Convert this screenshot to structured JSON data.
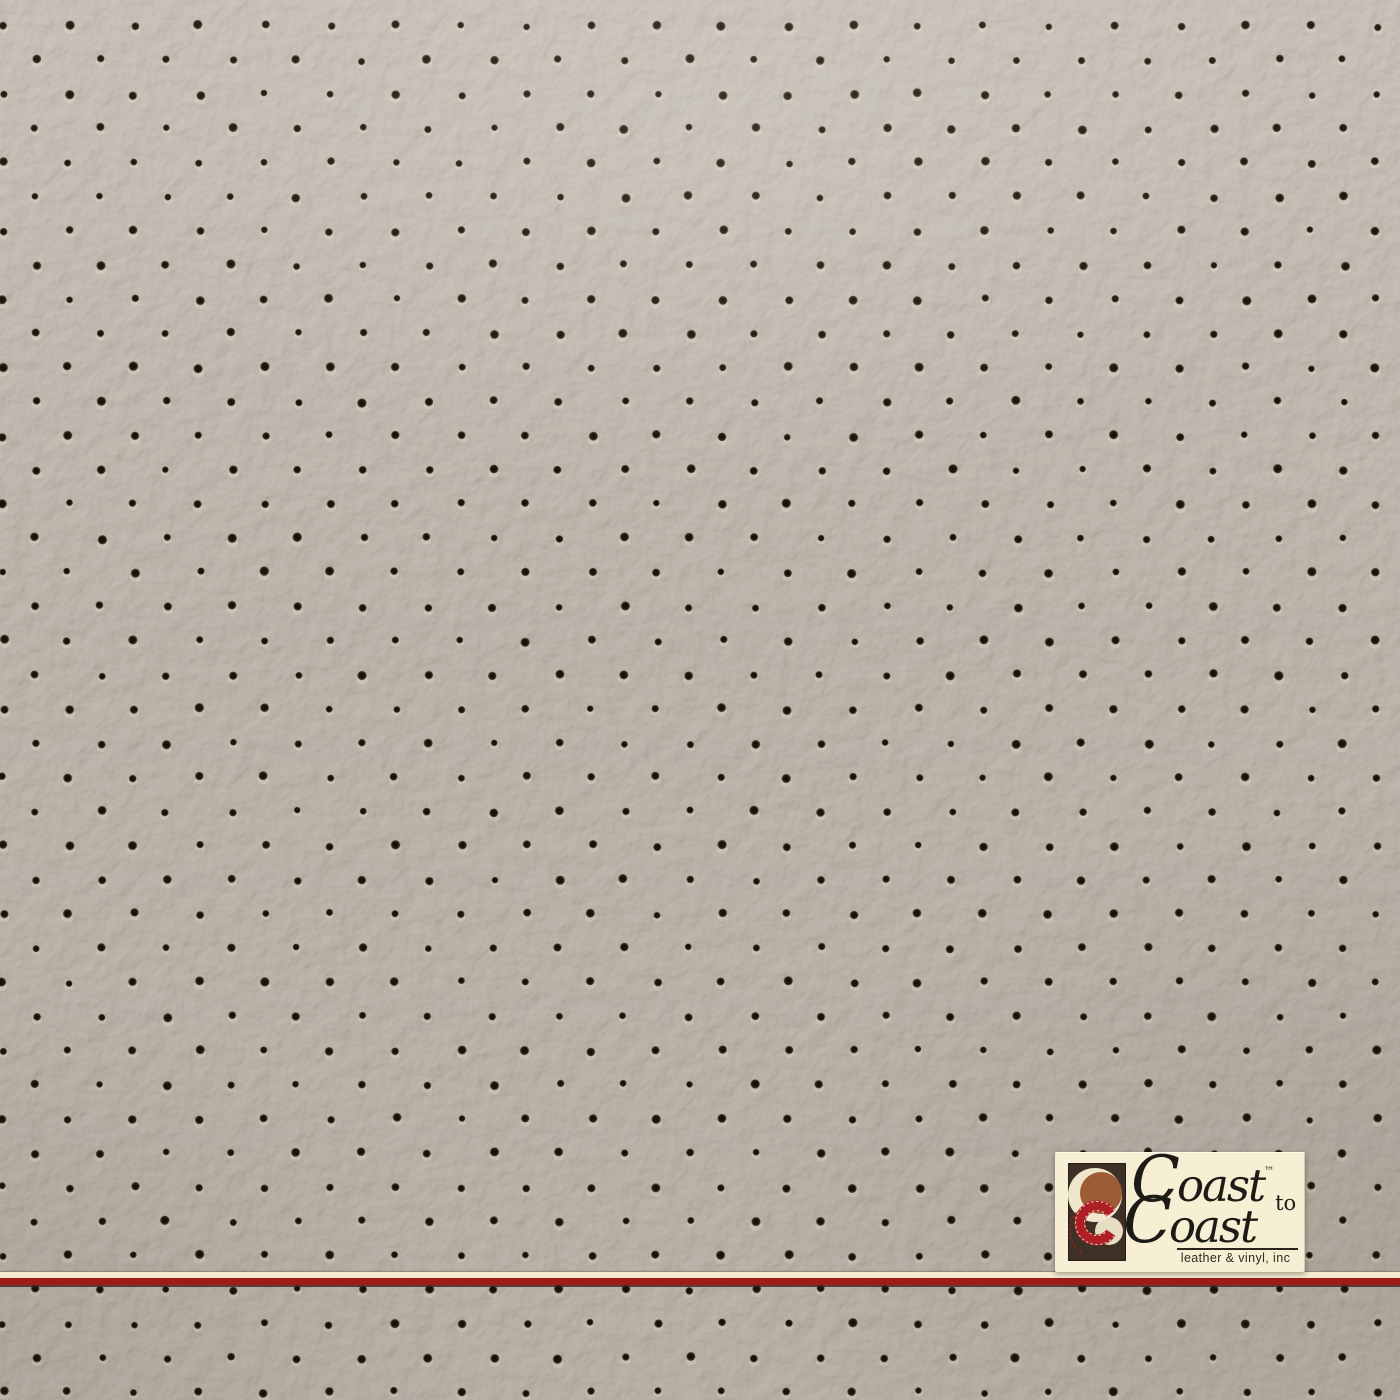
{
  "photo": {
    "subject": "Perforated leather upholstery swatch"
  },
  "material": {
    "base_color_top": "#b5aca0",
    "base_color_bottom": "#aea597",
    "hole_color": "#140d07",
    "hole_edge_color": "#3a2a1a",
    "pattern": {
      "origin_x": 3,
      "origin_y": 26,
      "hole_spacing_x": 65.4,
      "row_spacing_y": 34.15,
      "row_offset_x": 32.7,
      "hole_diameter": 8.6
    }
  },
  "accent_stripe": {
    "cream": "#f3e9cf",
    "red": "#9c1c17",
    "shadow": "#40231c"
  },
  "logo": {
    "brand": "Coast to Coast",
    "word1_initial": "C",
    "word1_rest": "oast",
    "trademark": "™",
    "connector": "to",
    "word2_initial": "C",
    "word2_rest": "oast",
    "tagline": "leather & vinyl, inc",
    "colors": {
      "background": "#f6efd4",
      "text": "#1d1b16",
      "mark_rect": "#3e3027",
      "mark_cream": "#efe7cb",
      "mark_sienna": "#9d5c35",
      "mark_red": "#ad2025",
      "rule": "#28251d"
    }
  }
}
